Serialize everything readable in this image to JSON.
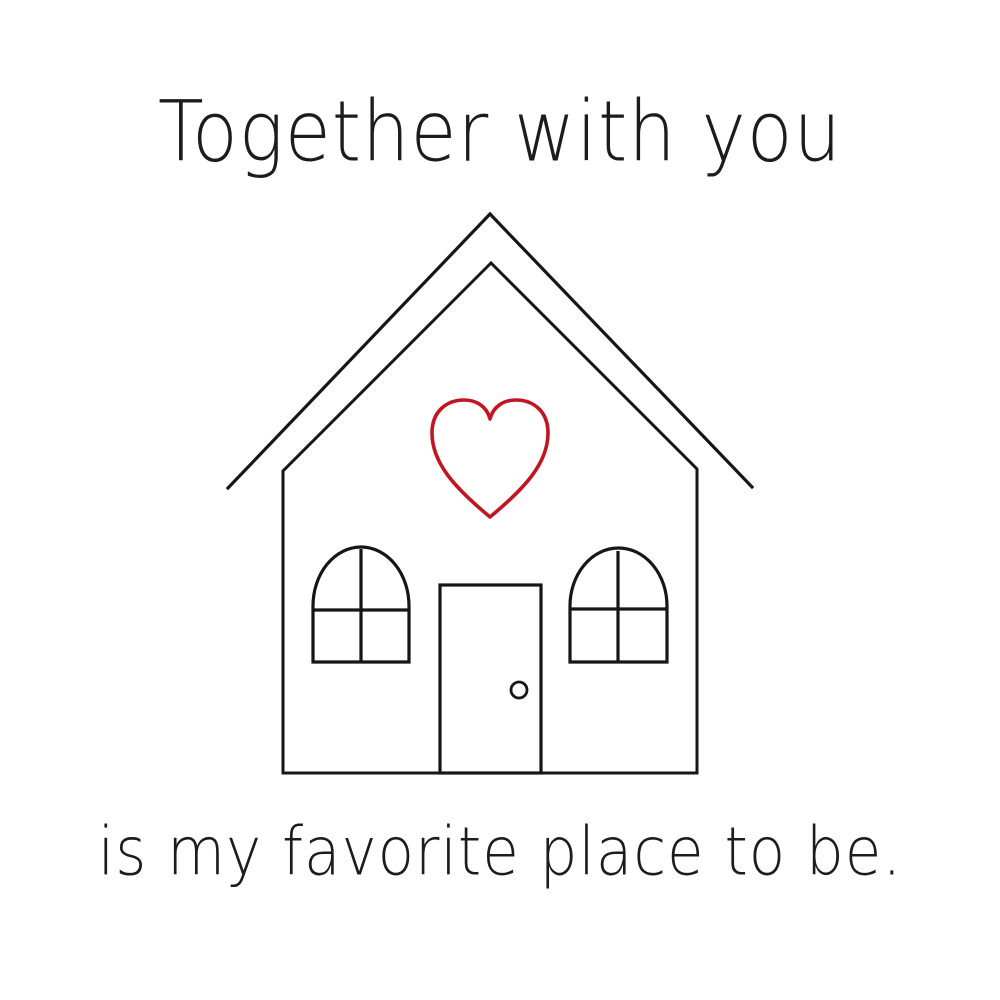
{
  "page": {
    "background_color": "#ffffff",
    "text_color": "#1c1c1c"
  },
  "texts": {
    "title": "Together with you",
    "caption": "is my favorite place to be."
  },
  "illustration": {
    "description": "outline drawing of a house with a red heart on the gable",
    "line_color": "#161616",
    "heart_color": "#c11622"
  }
}
